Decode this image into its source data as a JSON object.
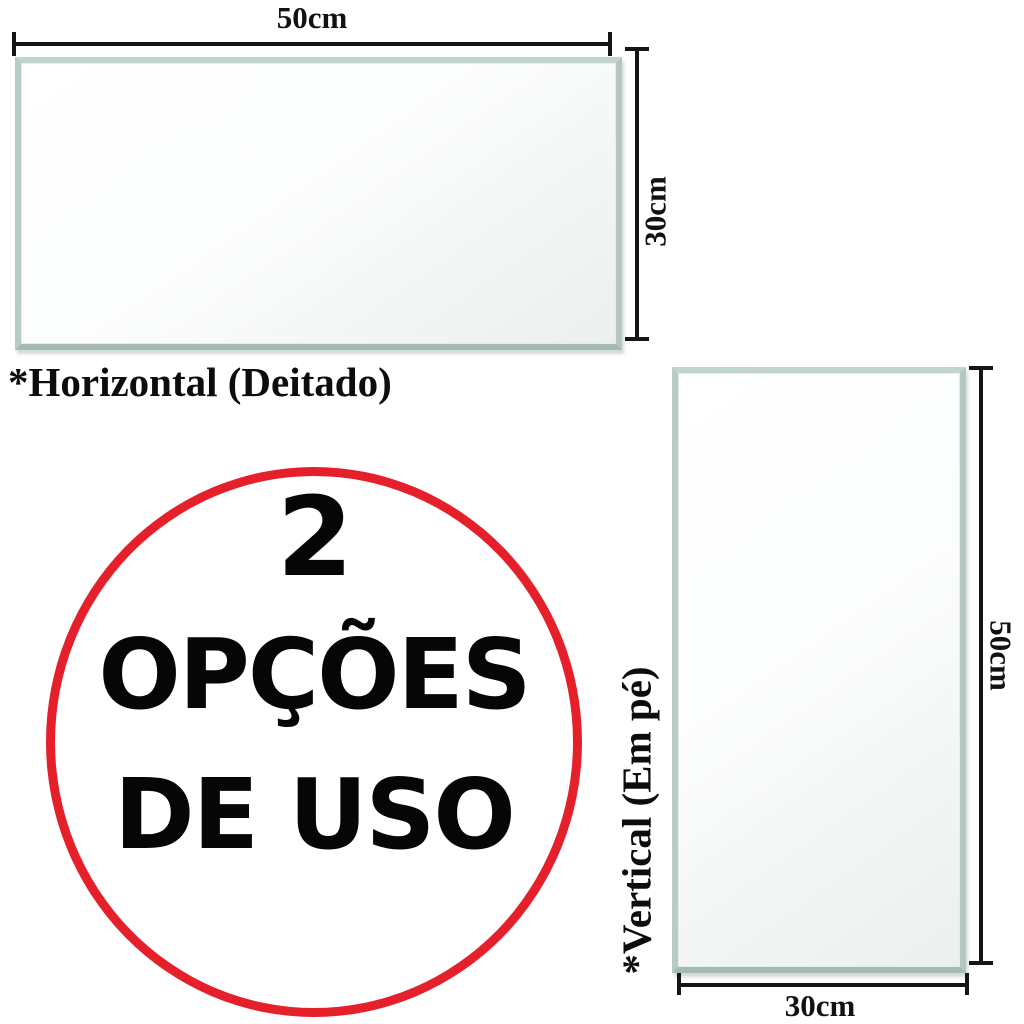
{
  "background_color": "#ffffff",
  "colors": {
    "accent_red": "#e5202a",
    "line_color": "#151515",
    "mirror_edge": "#bdcfcb",
    "text_black": "#0d0d0d"
  },
  "horizontal_option": {
    "caption": "*Horizontal (Deitado)",
    "top_dimension": "50cm",
    "side_dimension": "30cm"
  },
  "vertical_option": {
    "caption": "*Vertical (Em pé)",
    "side_dimension": "50cm",
    "bottom_dimension": "30cm"
  },
  "usage_badge": {
    "count": "2",
    "word1": "OPÇÕES",
    "word2": "DE USO"
  }
}
